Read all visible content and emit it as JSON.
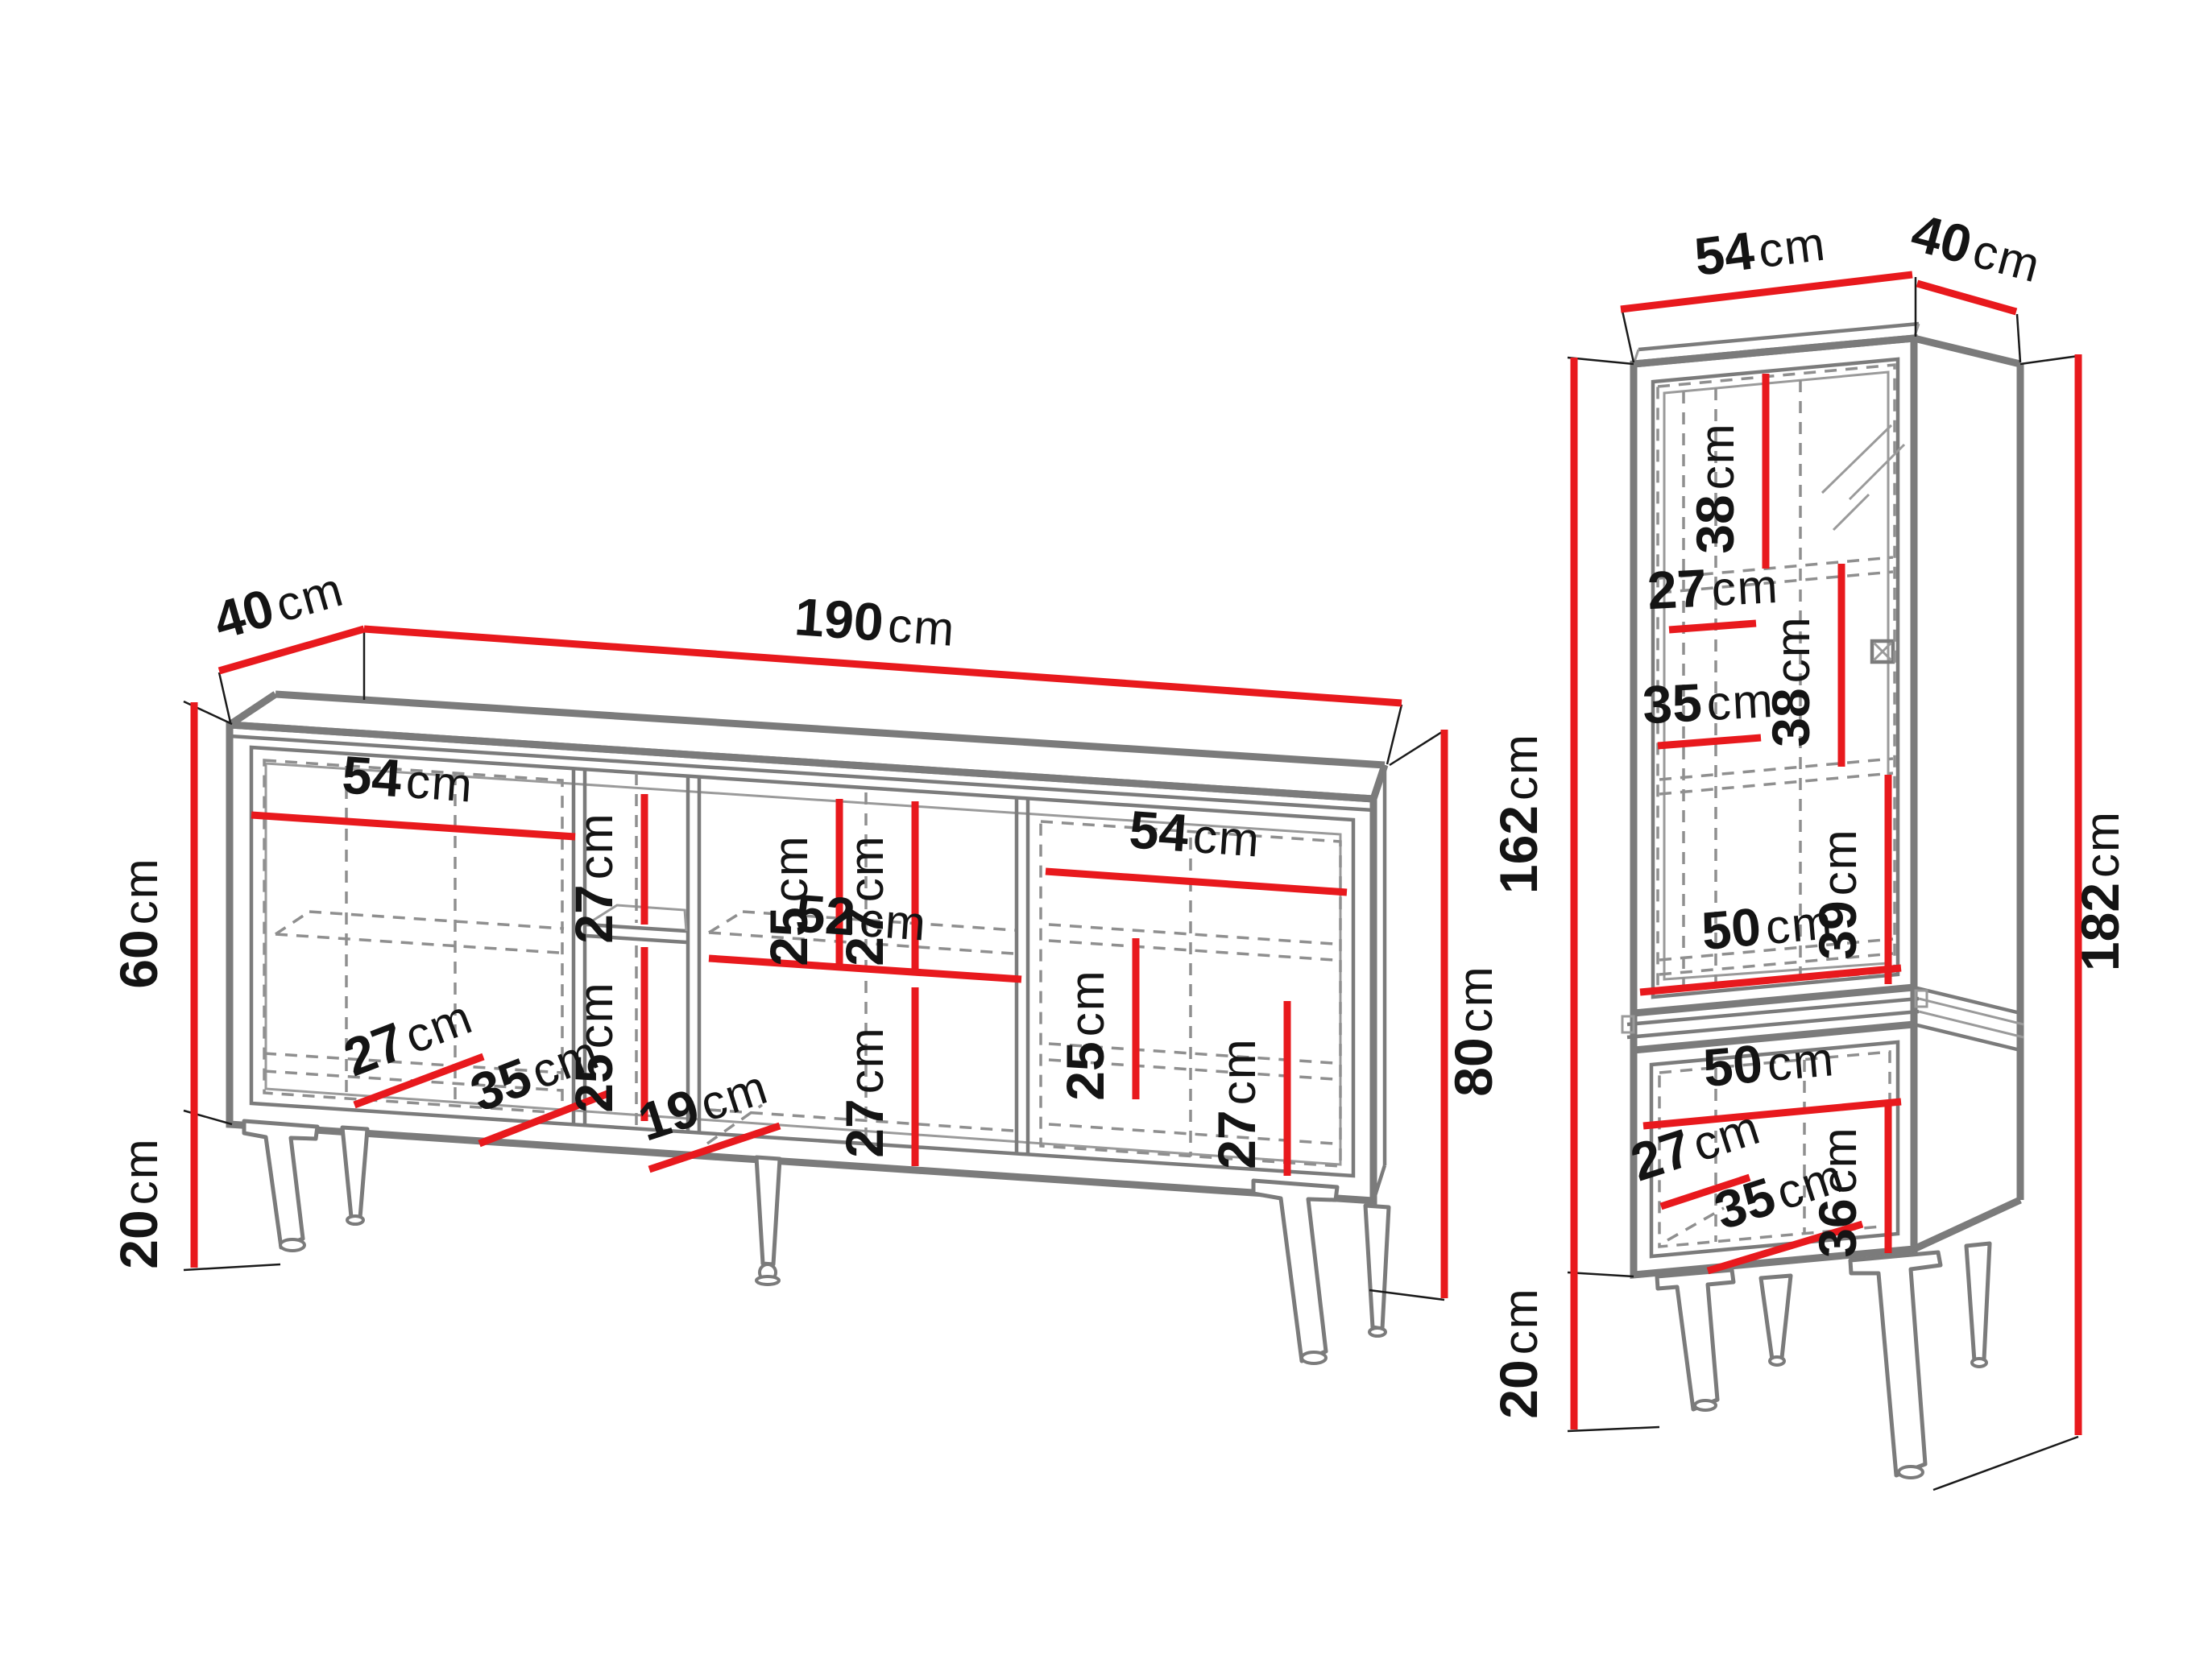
{
  "colors": {
    "dimension_red": "#e8191d",
    "outline_gray": "#7b7b7b",
    "detail_gray": "#9a9a9a",
    "dash_gray": "#8f8f8f",
    "text_black": "#141414"
  },
  "sb": {
    "depth": {
      "n": "40",
      "u": "cm"
    },
    "width": {
      "n": "190",
      "u": "cm"
    },
    "body_height": {
      "n": "60",
      "u": "cm"
    },
    "leg_height": {
      "n": "20",
      "u": "cm"
    },
    "total_height": {
      "n": "80",
      "u": "cm"
    },
    "left_door_width": {
      "n": "54",
      "u": "cm"
    },
    "left_shelf_depth": {
      "n": "27",
      "u": "cm"
    },
    "left_inner_depth": {
      "n": "35",
      "u": "cm"
    },
    "mid_upper_height": {
      "n": "27",
      "u": "cm"
    },
    "mid_lower_height": {
      "n": "25",
      "u": "cm"
    },
    "mid_width": {
      "n": "19",
      "u": "cm"
    },
    "center_upper_height_a": {
      "n": "25",
      "u": "cm"
    },
    "center_upper_height_b": {
      "n": "27",
      "u": "cm"
    },
    "center_width": {
      "n": "52",
      "u": "cm"
    },
    "center_lower_height": {
      "n": "27",
      "u": "cm"
    },
    "right_door_width": {
      "n": "54",
      "u": "cm"
    },
    "right_lower_height_a": {
      "n": "25",
      "u": "cm"
    },
    "right_lower_height_b": {
      "n": "27",
      "u": "cm"
    }
  },
  "vt": {
    "width": {
      "n": "54",
      "u": "cm"
    },
    "depth": {
      "n": "40",
      "u": "cm"
    },
    "body_height": {
      "n": "162",
      "u": "cm"
    },
    "leg_height": {
      "n": "20",
      "u": "cm"
    },
    "total_height": {
      "n": "182",
      "u": "cm"
    },
    "glass_height": {
      "n": "38",
      "u": "cm"
    },
    "shelf_depth_a": {
      "n": "27",
      "u": "cm"
    },
    "mid_height": {
      "n": "38",
      "u": "cm"
    },
    "shelf_depth_b": {
      "n": "35",
      "u": "cm"
    },
    "lower_height": {
      "n": "39",
      "u": "cm"
    },
    "upper_width": {
      "n": "50",
      "u": "cm"
    },
    "base_width": {
      "n": "50",
      "u": "cm"
    },
    "base_depth_a": {
      "n": "27",
      "u": "cm"
    },
    "base_depth_b": {
      "n": "35",
      "u": "cm"
    },
    "base_height": {
      "n": "36",
      "u": "cm"
    }
  }
}
